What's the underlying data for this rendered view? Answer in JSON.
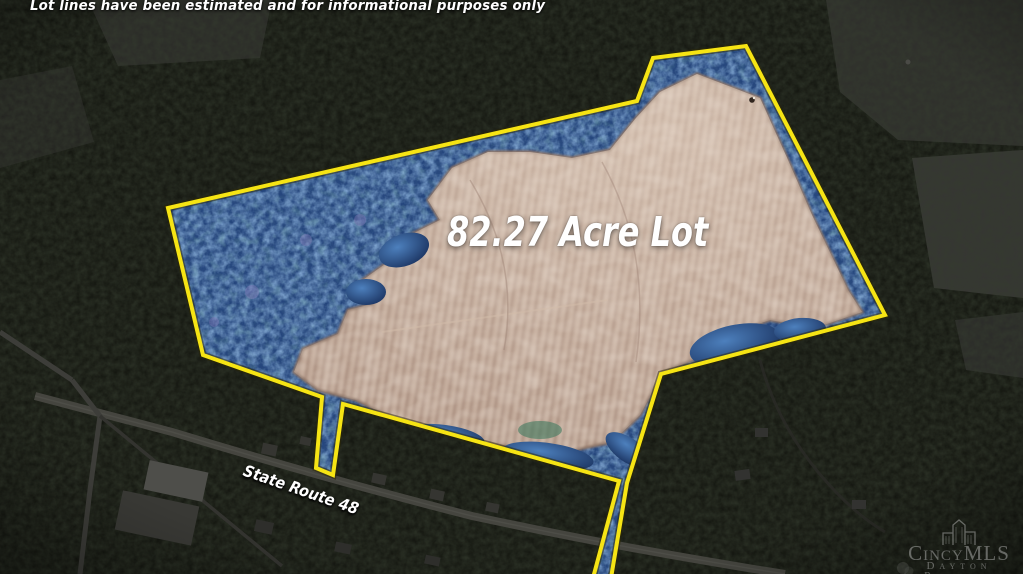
{
  "disclaimer": {
    "text": "Lot lines have been estimated and for informational purposes only"
  },
  "lot": {
    "label": "82.27 Acre Lot",
    "acreage": "82.27",
    "boundary_color": "#f6e414"
  },
  "road": {
    "label": "State Route 48"
  },
  "watermark": {
    "brand": "CincyMLS",
    "region": "Dayton",
    "org": "Realtors",
    "icon": "city-skyline-icon"
  },
  "colors": {
    "boundary_yellow": "#f6e414",
    "field_tan": "#b9a191",
    "forest_blue": "#2a4f8c",
    "outside_dark": "#141610",
    "label_white": "#ffffff"
  }
}
